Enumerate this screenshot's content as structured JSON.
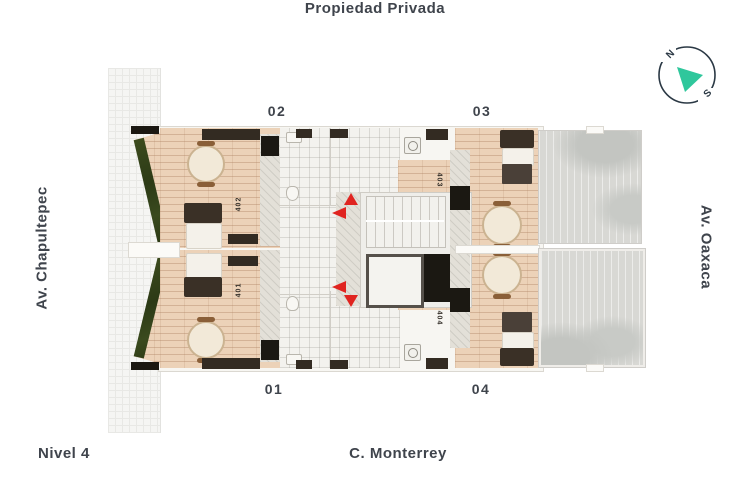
{
  "labels": {
    "top": "Propiedad Privada",
    "left_street": "Av. Chapultepec",
    "right_street": "Av. Oaxaca",
    "bottom_street": "C. Monterrey",
    "level": "Nivel 4"
  },
  "compass": {
    "north": "N",
    "south": "S"
  },
  "units": [
    {
      "label": "01",
      "apt": "401"
    },
    {
      "label": "02",
      "apt": "402"
    },
    {
      "label": "03",
      "apt": "403"
    },
    {
      "label": "04",
      "apt": "404"
    }
  ],
  "colors": {
    "text": "#3f444c",
    "arrow_red": "#e02420",
    "compass_teal": "#2fc79c",
    "wood_floor": "#ecd2b8",
    "terrace_gray": "#d8d8d4",
    "planter_green": "#35401f"
  }
}
